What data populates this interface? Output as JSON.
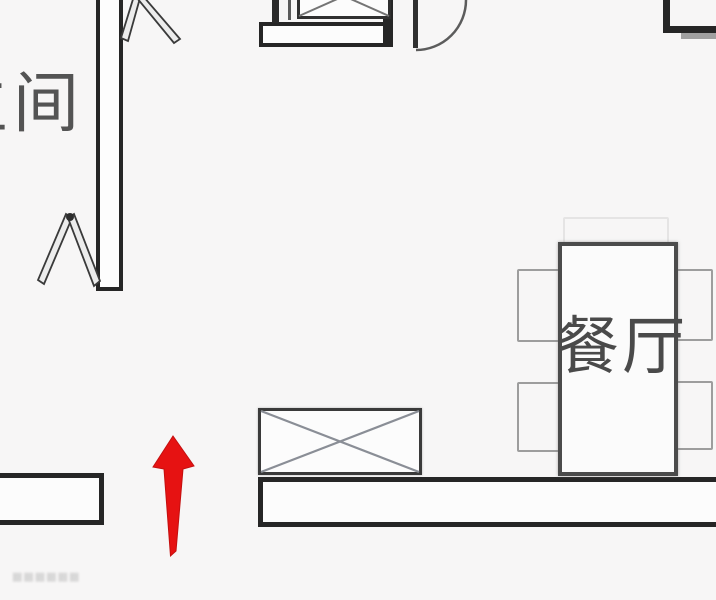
{
  "page": {
    "type": "apartment-floor-plan",
    "background": "#f7f6f6"
  },
  "labels": {
    "bathroom_partial": "生间",
    "dining_room": "餐厅",
    "watermark": "▦▦▦▦▦▦"
  },
  "annotation_arrow": {
    "direction": "up",
    "color": "#e61212"
  },
  "colors": {
    "wall": "#262626",
    "furniture_outline": "#4b4b4b",
    "chair_outline": "#9d9d9d",
    "cross_lines": "#8a8e96",
    "label_text": "#4a4a4a",
    "arrow_red": "#e61212"
  },
  "elements": {
    "walls": [
      "left-vertical-wall",
      "bottom-left-wall",
      "bottom-right-wall",
      "kitchen-wall-bar",
      "top-right-corner-wall"
    ],
    "furniture": [
      "dining-table",
      "dining-chairs",
      "crossed-cabinet",
      "kitchen-crossed-appliance"
    ],
    "doors": [
      "top-door-swing-arc",
      "top-folding-door",
      "bathroom-folding-door"
    ]
  }
}
